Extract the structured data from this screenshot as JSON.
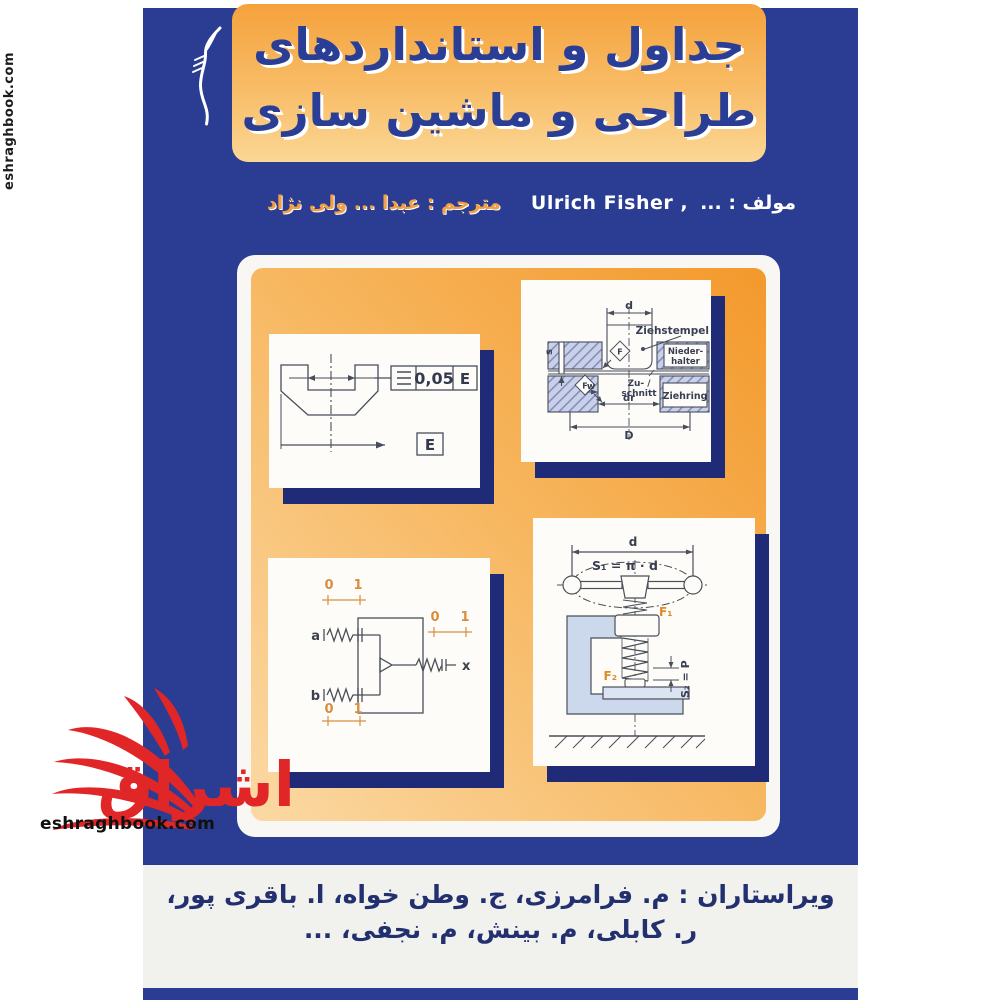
{
  "cover": {
    "title_line1": "جداول و استانداردهای",
    "title_line2": "طراحی و ماشین سازی",
    "author_label": "مولف : ...",
    "author_name": "Ulrich Fisher ,",
    "translator": "مترجم : عبدا ... ولی نژاد",
    "editors_line1": "ویراستاران :  م. فرامرزی، ج. وطن خواه، ا. باقری پور،",
    "editors_line2": "ر. کابلی،  م. بینش، م. نجفی، ..."
  },
  "watermark": {
    "site": "eshraghbook.com",
    "site_vertical": "eshraghbook.com",
    "logo_text": "اشراق"
  },
  "diagrams": {
    "tolerance": {
      "value": "0,05",
      "datum": "E",
      "datum_box": "E"
    },
    "die": {
      "d": "d",
      "punch_label": "Ziehstempel",
      "holder_line1": "Nieder-",
      "holder_line2": "halter",
      "blank_line1": "Zu- /",
      "blank_line2": "schnitt",
      "ring_label": "Ziehring",
      "s": "s",
      "w": "w",
      "dr": "dr",
      "D": "D",
      "F": "F"
    },
    "logic": {
      "a": "a",
      "b": "b",
      "x": "x",
      "zero": "0",
      "one": "1"
    },
    "clamp": {
      "d": "d",
      "s1": "S₁ = π · d",
      "f1": "F₁",
      "f2": "F₂",
      "s2": "S₂ = P"
    }
  },
  "colors": {
    "cover_blue": "#2a3d93",
    "shadow_navy": "#1f2b76",
    "orange_deep": "#f3992c",
    "orange_pale": "#fbd9a4",
    "title_blue": "#2b3e96",
    "translator_orange": "#f2a044",
    "editors_blue": "#233070",
    "watermark_red": "#e02626",
    "hatch_fill": "#c9d0e8"
  }
}
